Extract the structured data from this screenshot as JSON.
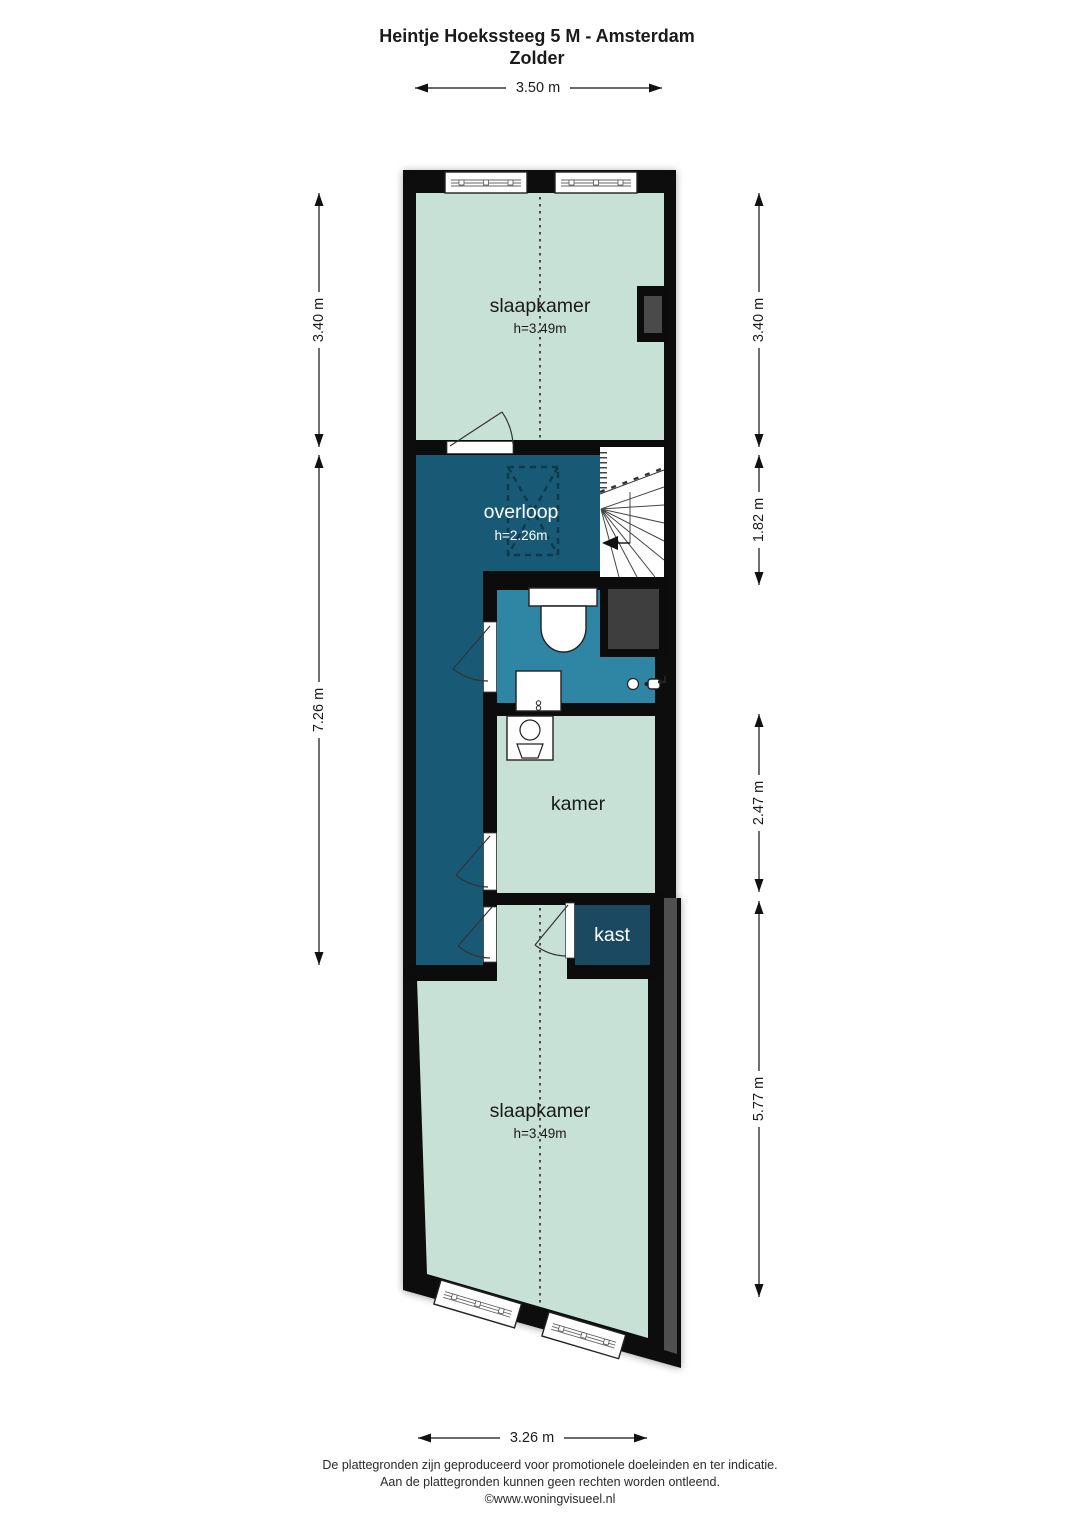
{
  "title": {
    "line1": "Heintje Hoekssteeg 5 M - Amsterdam",
    "line2": "Zolder"
  },
  "rooms": {
    "slaapkamer_top": {
      "label": "slaapkamer",
      "height": "h=3.49m"
    },
    "overloop": {
      "label": "overloop",
      "height": "h=2.26m"
    },
    "kamer": {
      "label": "kamer"
    },
    "kast": {
      "label": "kast"
    },
    "slaapkamer_bottom": {
      "label": "slaapkamer",
      "height": "h=3.49m"
    }
  },
  "dimensions": {
    "top": "3.50 m",
    "bottom": "3.26 m",
    "left": [
      "3.40 m",
      "7.26 m"
    ],
    "right": [
      "3.40 m",
      "1.82 m",
      "2.47 m",
      "5.77 m"
    ]
  },
  "footer": {
    "line1": "De plattegronden zijn geproduceerd voor promotionele doeleinden en ter indicatie.",
    "line2": "Aan de plattegronden kunnen geen rechten worden ontleend.",
    "line3": "©www.woningvisueel.nl"
  },
  "colors": {
    "room_fill": "#c8e1d7",
    "landing_fill": "#185a75",
    "bathroom_fill": "#2e85a4",
    "closet_fill": "#1b4962",
    "wall": "#0c0c0c",
    "shaft_gray": "#3e3e3e",
    "neighbor_wall_gray": "#4f4f4f"
  }
}
